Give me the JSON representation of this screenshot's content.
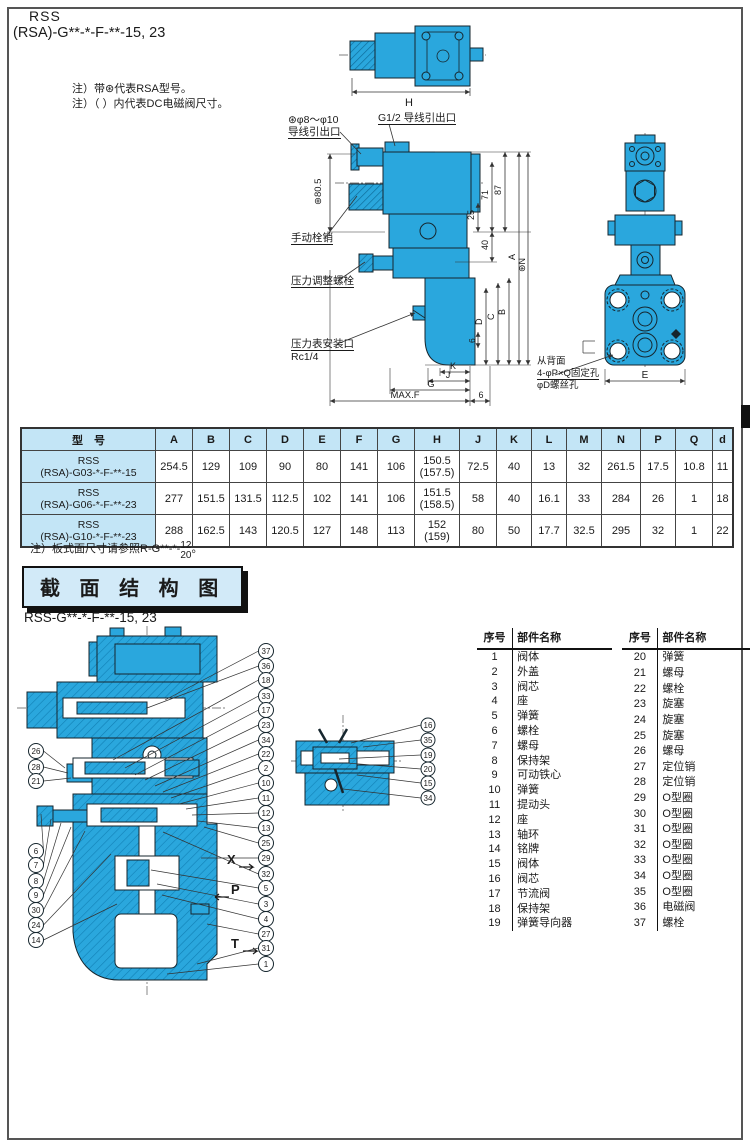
{
  "page": {
    "title_line1": "RSS",
    "title_line2": "(RSA)-G**-*-F-**-15, 23",
    "note1": "注）带⊛代表RSA型号。",
    "note2": "注）（ ）内代表DC电磁阀尺寸。"
  },
  "top_view": {
    "dim_H": "H"
  },
  "front_view": {
    "label_lead_star_1": "⊛φ8～φ10",
    "label_lead_star_2": "导线引出口",
    "label_lead_g12": "G1/2 导线引出口",
    "dim_80_5": "⊛80.5",
    "label_manual_pin": "手动栓销",
    "label_pressure_adjust": "压力调整螺栓",
    "label_gauge_port_1": "压力表安装口",
    "label_gauge_port_2": "Rc1/4",
    "dim_87": "87",
    "dim_71": "71",
    "dim_25": "25",
    "dim_40": "40",
    "dim_A": "A",
    "dim_N": "⊛N",
    "dim_B": "B",
    "dim_C": "C",
    "dim_D": "D",
    "dim_6_side": "6",
    "dim_K": "K",
    "dim_J": "J",
    "dim_G": "G",
    "dim_MAXF": "MAX.F",
    "dim_6_bottom": "6"
  },
  "side_view": {
    "label_back_1": "从背面",
    "label_back_2": "4-φP×Q固定孔",
    "label_back_3": "φD螺丝孔",
    "dim_E": "E"
  },
  "dim_table": {
    "header_model": "型　号",
    "headers": [
      "A",
      "B",
      "C",
      "D",
      "E",
      "F",
      "G",
      "H",
      "J",
      "K",
      "L",
      "M",
      "N",
      "P",
      "Q",
      "d"
    ],
    "rows": [
      {
        "model_1": "RSS",
        "model_2": "(RSA)-G03-*-F-**-15",
        "values": [
          "254.5",
          "129",
          "109",
          "90",
          "80",
          "141",
          "106",
          "150.5\n(157.5)",
          "72.5",
          "40",
          "13",
          "32",
          "261.5",
          "17.5",
          "10.8",
          "11"
        ]
      },
      {
        "model_1": "RSS",
        "model_2": "(RSA)-G06-*-F-**-23",
        "values": [
          "277",
          "151.5",
          "131.5",
          "112.5",
          "102",
          "141",
          "106",
          "151.5\n(158.5)",
          "58",
          "40",
          "16.1",
          "33",
          "284",
          "26",
          "1",
          "18"
        ]
      },
      {
        "model_1": "RSS",
        "model_2": "(RSA)-G10-*-F-**-23",
        "values": [
          "288",
          "162.5",
          "143",
          "120.5",
          "127",
          "148",
          "113",
          "152\n(159)",
          "80",
          "50",
          "17.7",
          "32.5",
          "295",
          "32",
          "1",
          "22"
        ]
      }
    ],
    "note_prefix": "注）板式面尺寸请参照R-G**-*-",
    "note_frac_top": "12",
    "note_frac_bottom": "20",
    "note_suffix": "。"
  },
  "section": {
    "header": "截 面 结 构 图",
    "subtitle": "RSS-G**-*-F-**-15, 23",
    "port_X": "X",
    "port_P": "P",
    "port_T": "T"
  },
  "callouts": {
    "main_right": [
      "37",
      "36",
      "18",
      "33",
      "17",
      "23",
      "34",
      "22",
      "2",
      "10",
      "11",
      "12",
      "13",
      "25",
      "29",
      "32",
      "5",
      "3",
      "4",
      "27",
      "31",
      "1"
    ],
    "main_left": [
      "26",
      "28",
      "21",
      "6",
      "7",
      "8",
      "9",
      "30",
      "24",
      "14"
    ],
    "small_right": [
      "16",
      "35",
      "19",
      "20",
      "15",
      "34"
    ]
  },
  "parts_table": {
    "col_no": "序号",
    "col_name": "部件名称",
    "rows": [
      [
        "1",
        "阀体",
        "20",
        "弹簧"
      ],
      [
        "2",
        "外盖",
        "21",
        "螺母"
      ],
      [
        "3",
        "阀芯",
        "22",
        "螺栓"
      ],
      [
        "4",
        "座",
        "23",
        "旋塞"
      ],
      [
        "5",
        "弹簧",
        "24",
        "旋塞"
      ],
      [
        "6",
        "螺栓",
        "25",
        "旋塞"
      ],
      [
        "7",
        "螺母",
        "26",
        "螺母"
      ],
      [
        "8",
        "保持架",
        "27",
        "定位销"
      ],
      [
        "9",
        "可动铁心",
        "28",
        "定位销"
      ],
      [
        "10",
        "弹簧",
        "29",
        "O型圈"
      ],
      [
        "11",
        "提动头",
        "30",
        "O型圈"
      ],
      [
        "12",
        "座",
        "31",
        "O型圈"
      ],
      [
        "13",
        "轴环",
        "32",
        "O型圈"
      ],
      [
        "14",
        "铭牌",
        "33",
        "O型圈"
      ],
      [
        "15",
        "阀体",
        "34",
        "O型圈"
      ],
      [
        "16",
        "阀芯",
        "35",
        "O型圈"
      ],
      [
        "17",
        "节流阀",
        "36",
        "电磁阀"
      ],
      [
        "18",
        "保持架",
        "37",
        "螺栓"
      ],
      [
        "19",
        "弹簧导向器",
        "",
        ""
      ]
    ]
  },
  "colors": {
    "valve_blue": "#2aa7dd",
    "valve_blue_dark": "#0f7fb3",
    "outline": "#16262e",
    "table_header_bg": "#c3e5f6",
    "section_box_bg": "#d2eaf8"
  }
}
